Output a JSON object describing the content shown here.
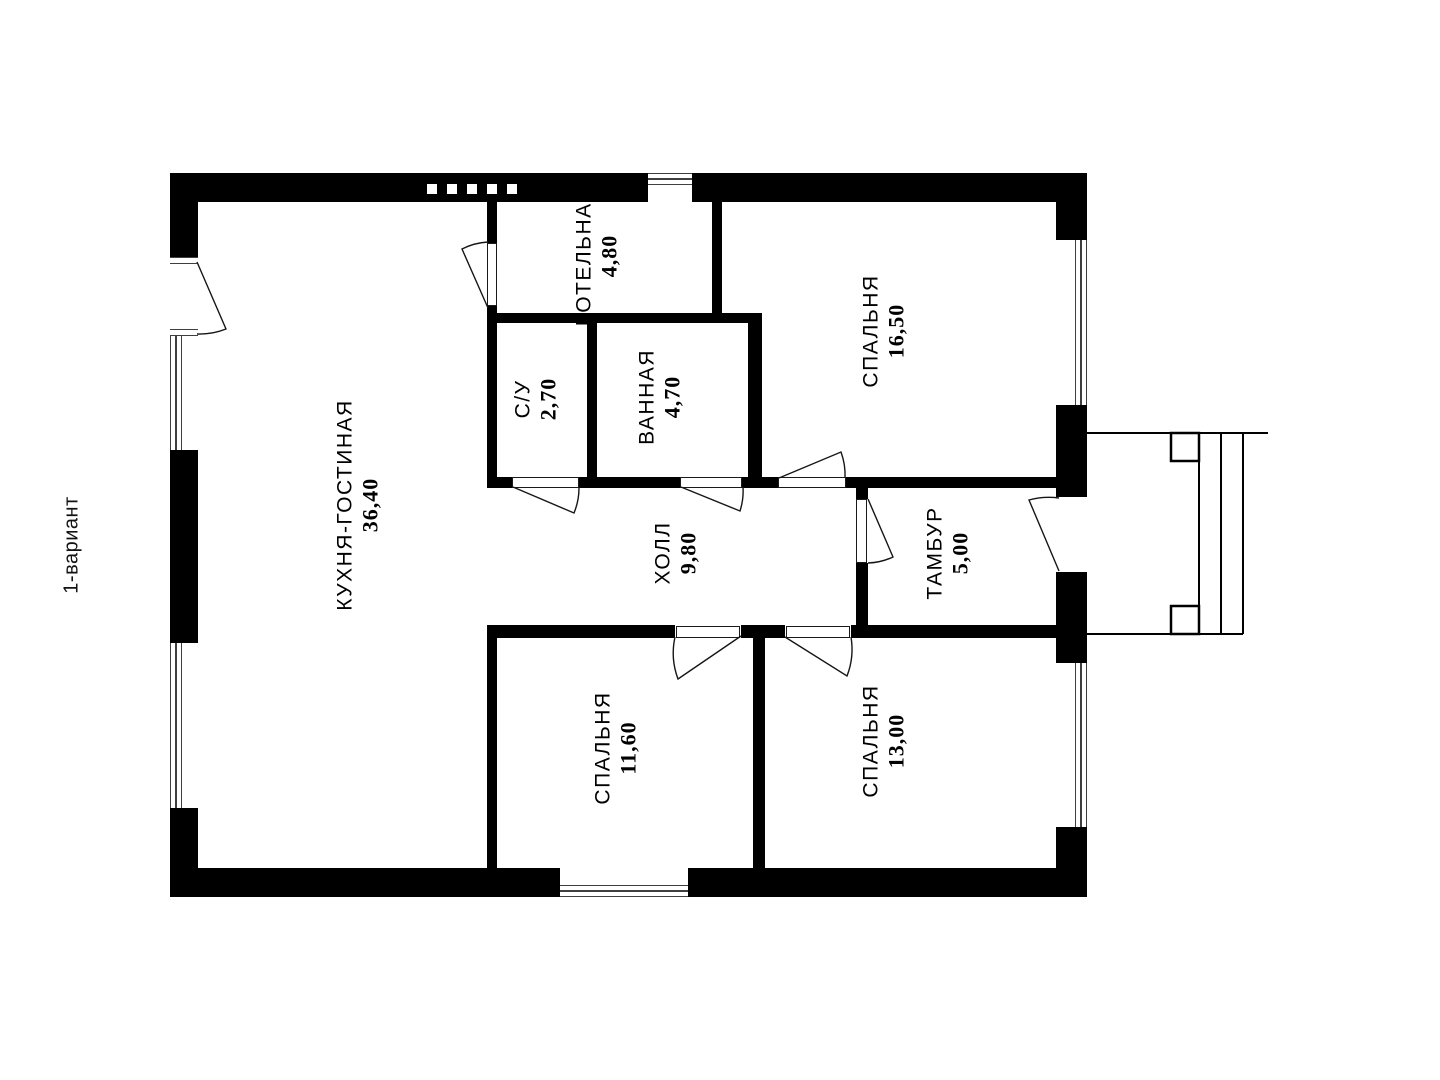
{
  "plan": {
    "variant_label": "1-вариант",
    "rooms": [
      {
        "id": "kitchen-living",
        "name": "КУХНЯ-ГОСТИНАЯ",
        "area": "36,40"
      },
      {
        "id": "boiler-room",
        "name": "КОТЕЛЬНАЯ",
        "area": "4,80"
      },
      {
        "id": "wc",
        "name": "С/У",
        "area": "2,70"
      },
      {
        "id": "bathroom",
        "name": "ВАННАЯ",
        "area": "4,70"
      },
      {
        "id": "bedroom-1",
        "name": "СПАЛЬНЯ",
        "area": "16,50"
      },
      {
        "id": "hall",
        "name": "ХОЛЛ",
        "area": "9,80"
      },
      {
        "id": "vestibule",
        "name": "ТАМБУР",
        "area": "5,00"
      },
      {
        "id": "bedroom-2",
        "name": "СПАЛЬНЯ",
        "area": "11,60"
      },
      {
        "id": "bedroom-3",
        "name": "СПАЛЬНЯ",
        "area": "13,00"
      }
    ],
    "colors": {
      "wall": "#000000",
      "window_line": "#3f3f3f",
      "background": "#ffffff"
    }
  }
}
